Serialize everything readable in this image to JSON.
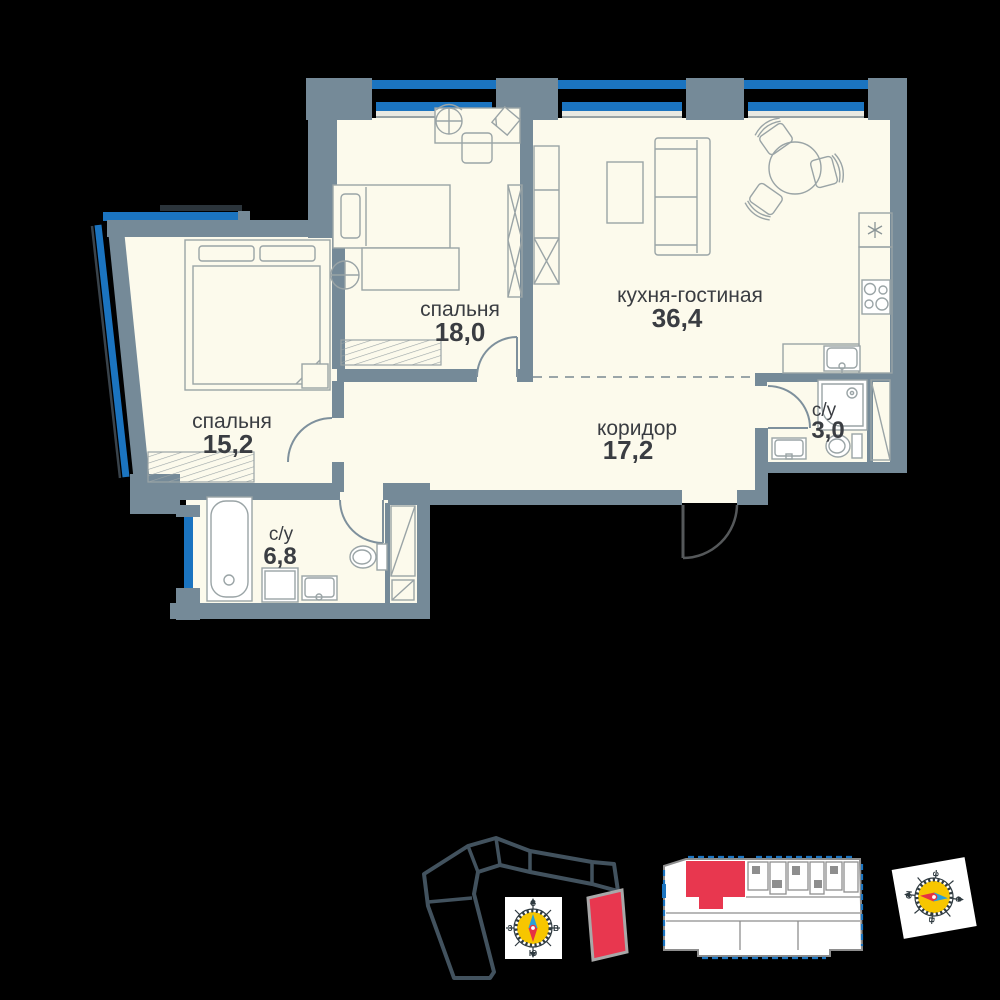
{
  "plan": {
    "title": "apartment-floorplan",
    "rooms": [
      {
        "key": "bedroom-18",
        "name": "спальня",
        "area": "18,0"
      },
      {
        "key": "kitchen-living",
        "name": "кухня-гостиная",
        "area": "36,4"
      },
      {
        "key": "bedroom-15",
        "name": "спальня",
        "area": "15,2"
      },
      {
        "key": "corridor",
        "name": "коридор",
        "area": "17,2"
      },
      {
        "key": "bathroom-3",
        "name": "с/у",
        "area": "3,0"
      },
      {
        "key": "bathroom-68",
        "name": "с/у",
        "area": "6,8"
      }
    ],
    "icons": [
      "fridge-asterisk-icon",
      "stove-icon",
      "sink-icon",
      "toilet-icon",
      "shower-icon",
      "bathtub-icon",
      "washing-machine-icon",
      "radiator-icon",
      "wardrobe-icon",
      "bed-icon",
      "sofa-icon",
      "dining-table-icon",
      "desk-icon"
    ]
  },
  "compass": {
    "north": "С",
    "south": "Ю",
    "west": "З",
    "east": "В"
  },
  "minimap": {
    "highlight": "current-apartment"
  },
  "site_plan": {
    "highlight": "current-building-section"
  },
  "colors": {
    "wall": "#758A98",
    "floor": "#FCFAEC",
    "window_blue": "#1B74C0",
    "highlight_red": "#E8374F",
    "site_outline": "#42525E",
    "label_text": "#3A3D42",
    "compass_face": "#F7C600",
    "needle_red": "#E63144",
    "needle_blue": "#2B9FD8"
  }
}
